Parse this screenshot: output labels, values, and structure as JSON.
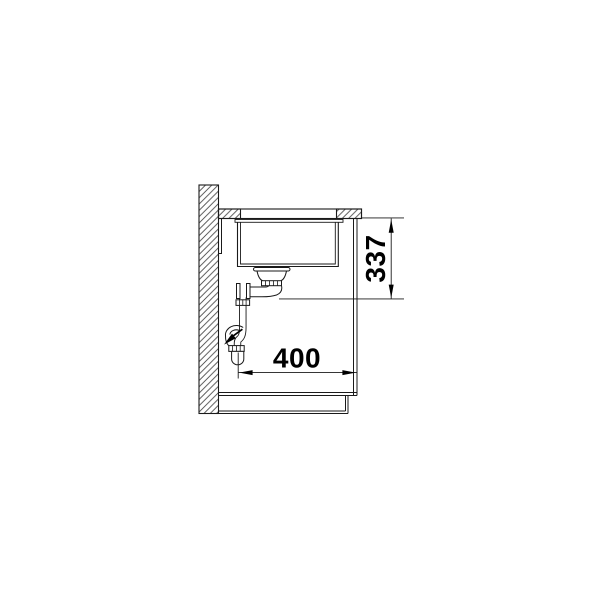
{
  "page": {
    "background_color": "#ffffff"
  },
  "drawing": {
    "kind": "technical-section-drawing",
    "subject": "undermount sink in base cabinet, side section with siphon drain",
    "colors": {
      "line": "#1a1a1a",
      "hatch": "#4a4a4a",
      "text": "#000000",
      "background": "#ffffff"
    },
    "dimensions": {
      "vertical": {
        "value": "337",
        "orientation": "vertical"
      },
      "horizontal": {
        "value": "400",
        "orientation": "horizontal"
      }
    }
  }
}
